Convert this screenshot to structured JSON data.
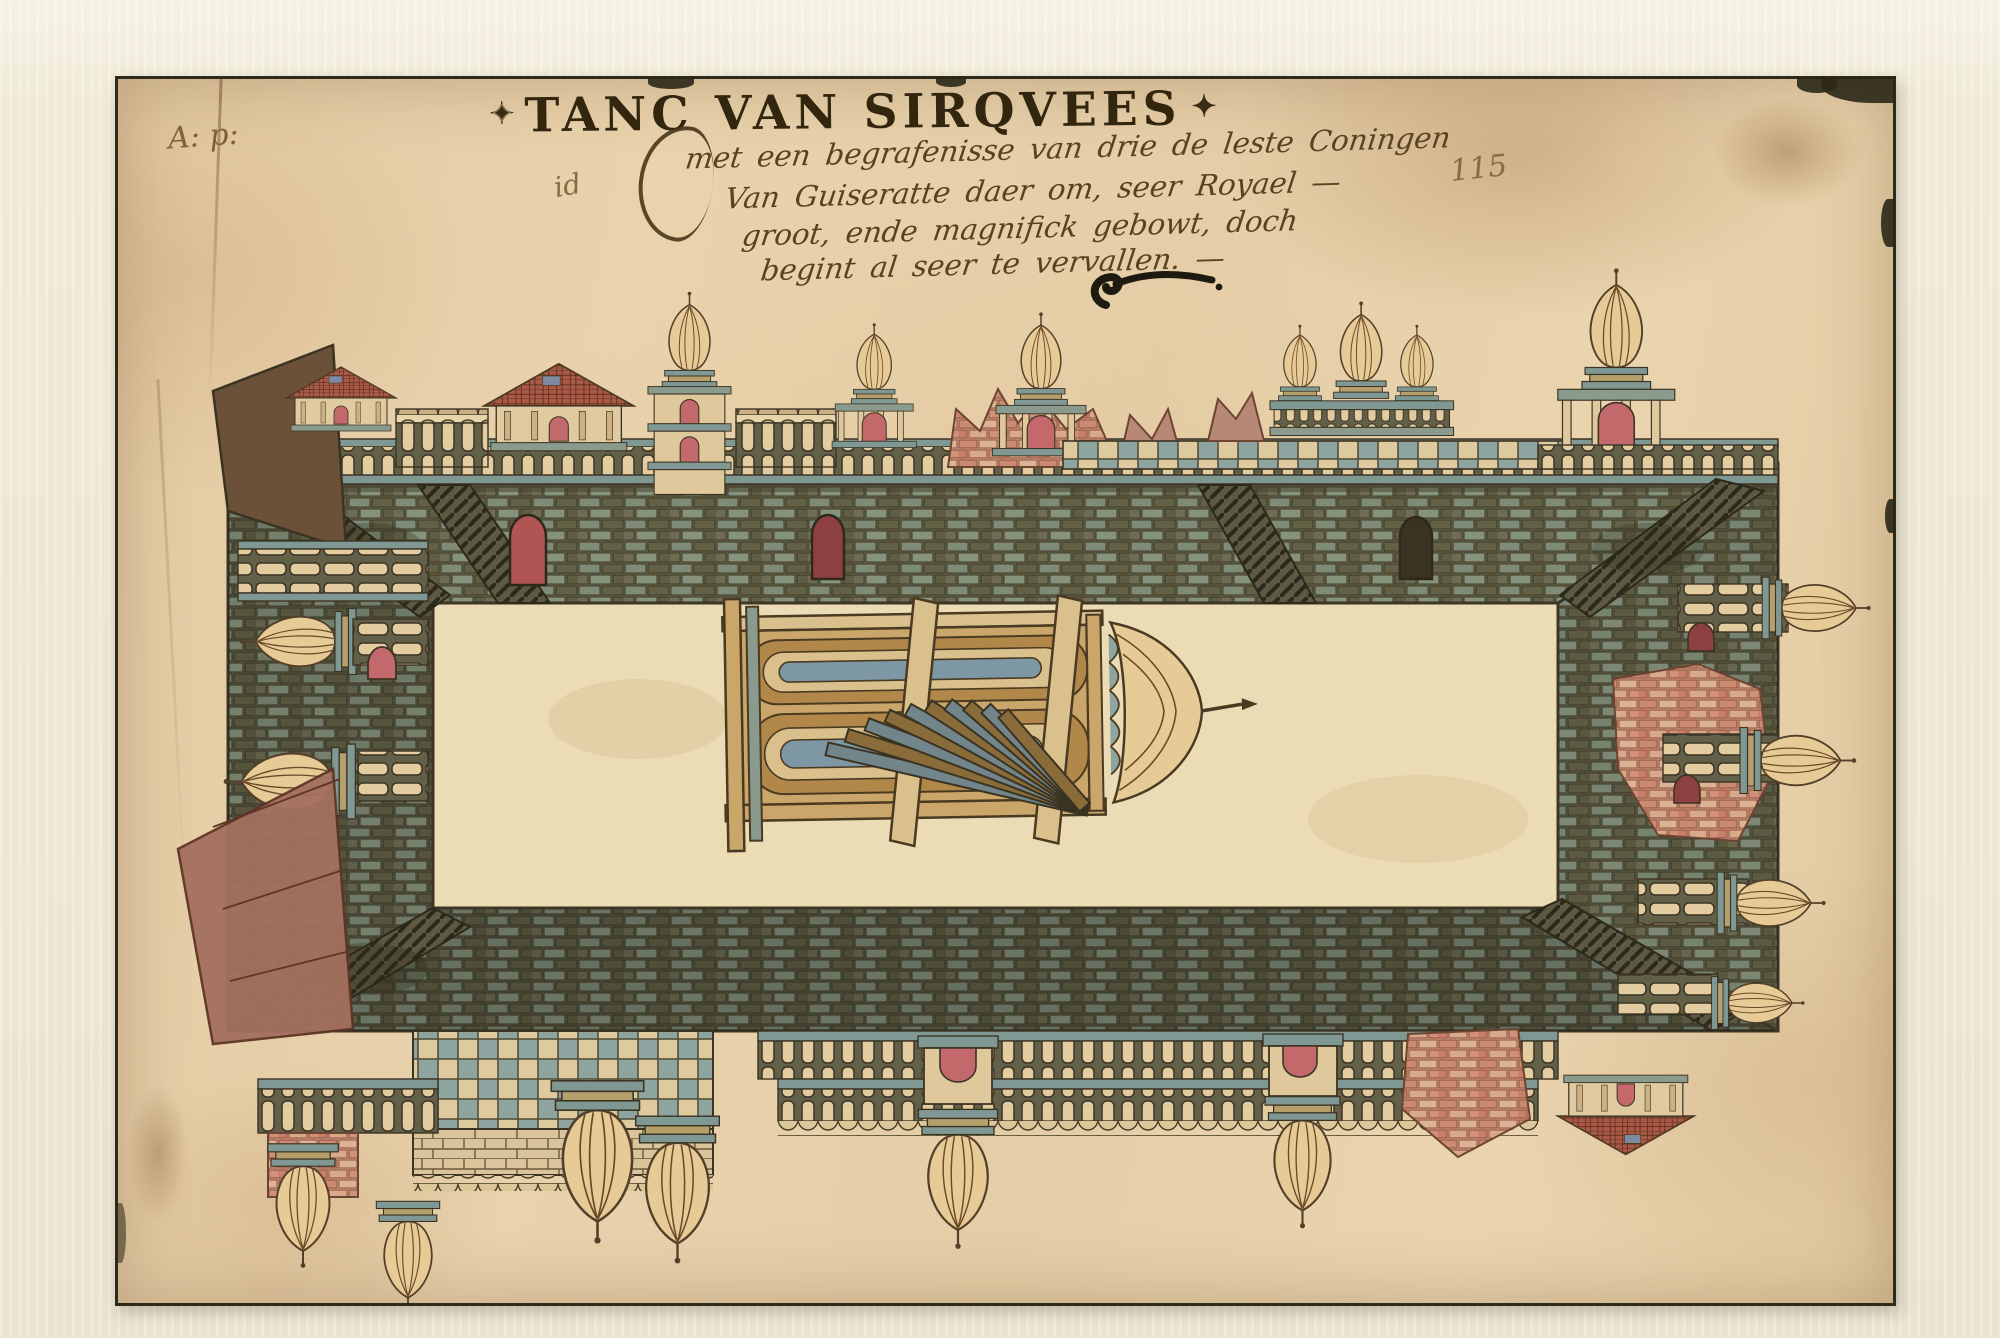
{
  "artwork": {
    "title": {
      "ornament_left": "✦",
      "text": "TANC VAN SIRQVEES",
      "ornament_right": "✦"
    },
    "inscription_lines": [
      "met een begrafenisse van drie de leste Coningen",
      "Van Guiseratte daer om, seer Royael —",
      "groot, ende magnifick gebowt, doch",
      "begint al seer te vervallen. —"
    ],
    "marks": {
      "collection_mark": "A: p:",
      "margin_mark": "id",
      "folio_number": "115"
    }
  },
  "palette": {
    "mat_cream": "#ece6d2",
    "paper_tan": "#e6cfa8",
    "ink_title": "#32260f",
    "ink_hand": "#584220",
    "wall_olive": "#767457",
    "wall_teal": "#8d9c85",
    "rail_teal": "#7f9894",
    "baluster_cream": "#e3cda0",
    "brick_pink": "#d4a184",
    "arch_red": "#c4696b",
    "roof_red": "#a85a46",
    "dome_tan": "#e6cb97",
    "tower_gold": "#b2884a",
    "tower_blue": "#7d97a5",
    "floor_cream": "#ecdcb6",
    "outline_dark": "#45402c"
  }
}
